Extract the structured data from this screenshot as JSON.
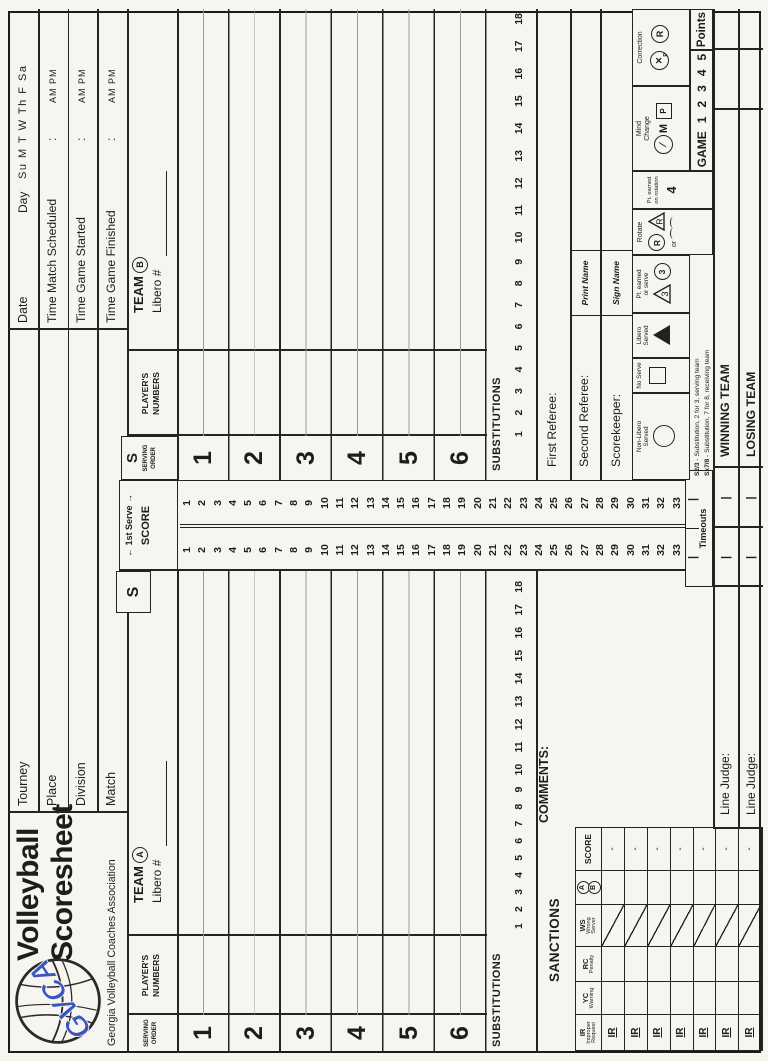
{
  "logo": {
    "gvca": "GVCA",
    "title_line1": "Volleyball",
    "title_line2": "Scoresheet",
    "association": "Georgia Volleyball Coaches Association"
  },
  "match_fields": {
    "tourney": "Tourney",
    "place": "Place",
    "division": "Division",
    "match": "Match"
  },
  "date_block": {
    "date": "Date",
    "day": "Day",
    "days": "Su M T W Th F Sa",
    "rows": [
      {
        "label": "Time Match Scheduled",
        "colon": ":",
        "ampm": "AM PM"
      },
      {
        "label": "Time Game Started",
        "colon": ":",
        "ampm": "AM PM"
      },
      {
        "label": "Time Game Finished",
        "colon": ":",
        "ampm": "AM PM"
      }
    ]
  },
  "team_a": {
    "name": "TEAM",
    "badge": "A",
    "libero": "Libero #",
    "s": "S",
    "players_header": [
      "PLAYER'S",
      "NUMBERS"
    ],
    "serving_header": [
      "SERVING",
      "ORDER"
    ]
  },
  "team_b": {
    "name": "TEAM",
    "badge": "B",
    "libero": "Libero #",
    "s": "S",
    "players_header": [
      "PLAYER'S",
      "NUMBERS"
    ],
    "serving_header": [
      "SERVING",
      "ORDER"
    ]
  },
  "serving_numbers": [
    1,
    2,
    3,
    4,
    5,
    6
  ],
  "score_strip": {
    "arrow_left": "←",
    "arrow_right": "→",
    "first_serve": "1st Serve",
    "score": "SCORE",
    "numbers": [
      1,
      2,
      3,
      4,
      5,
      6,
      7,
      8,
      9,
      10,
      11,
      12,
      13,
      14,
      15,
      16,
      17,
      18,
      19,
      20,
      21,
      22,
      23,
      24,
      25,
      26,
      27,
      28,
      29,
      30,
      31,
      32,
      33
    ]
  },
  "substitutions": {
    "label": "SUBSTITUTIONS",
    "numbers": [
      1,
      2,
      3,
      4,
      5,
      6,
      7,
      8,
      9,
      10,
      11,
      12,
      13,
      14,
      15,
      16,
      17,
      18
    ]
  },
  "timeouts": {
    "label": "Timeouts",
    "mark": "|"
  },
  "comments": "COMMENTS:",
  "sanctions": {
    "title": "SANCTIONS",
    "col_ir": [
      "IR",
      "Improper",
      "Request"
    ],
    "col_yc": [
      "YC",
      "Warning"
    ],
    "col_rc": [
      "RC",
      "Penalty"
    ],
    "col_ws": [
      "WS",
      "Wrong",
      "Server"
    ],
    "col_ab": [
      "A",
      "B"
    ],
    "col_score": "SCORE",
    "row_label": "IR",
    "row_dash": "-"
  },
  "officials": {
    "first_referee": "First Referee:",
    "second_referee": "Second Referee:",
    "scorekeeper": "Scorekeeper:",
    "print_name": "Print Name",
    "sign_name": "Sign Name"
  },
  "legend": {
    "non_libero": [
      "Non-Libero",
      "Served"
    ],
    "no_serve": "No Serve",
    "libero": [
      "Libero",
      "Served"
    ],
    "pt_serve": [
      "Pt. earned",
      "or serve"
    ],
    "pt_serve_tri": "3",
    "pt_serve_circ": "3",
    "rotate": "Rotate",
    "rotate_circ": "R",
    "rotate_tri": "R",
    "or": "or",
    "pt_rotation": [
      "Pt. earned",
      "on rotation"
    ],
    "pt_rotation_num": "4",
    "mind": [
      "Mind",
      "Change"
    ],
    "mind_m": "M",
    "mind_p": "P",
    "mind_slash": "∕",
    "correction": "Correction",
    "corr_x": "✕",
    "corr_p": "P",
    "corr_r": "R"
  },
  "notes": [
    {
      "lead": "S2/3",
      "rest": " - Substitution, 2 for 3, serving team"
    },
    {
      "lead": "Sx7/8",
      "rest": " - Substitution, 7 for 8, receiving team"
    }
  ],
  "game_row": {
    "game": "GAME",
    "numbers": [
      1,
      2,
      3,
      4,
      5
    ],
    "points": "Points"
  },
  "results": {
    "winning": "WINNING TEAM",
    "losing": "LOSING TEAM",
    "mark": "|"
  },
  "line_judges": [
    "Line Judge:",
    "Line Judge:"
  ]
}
